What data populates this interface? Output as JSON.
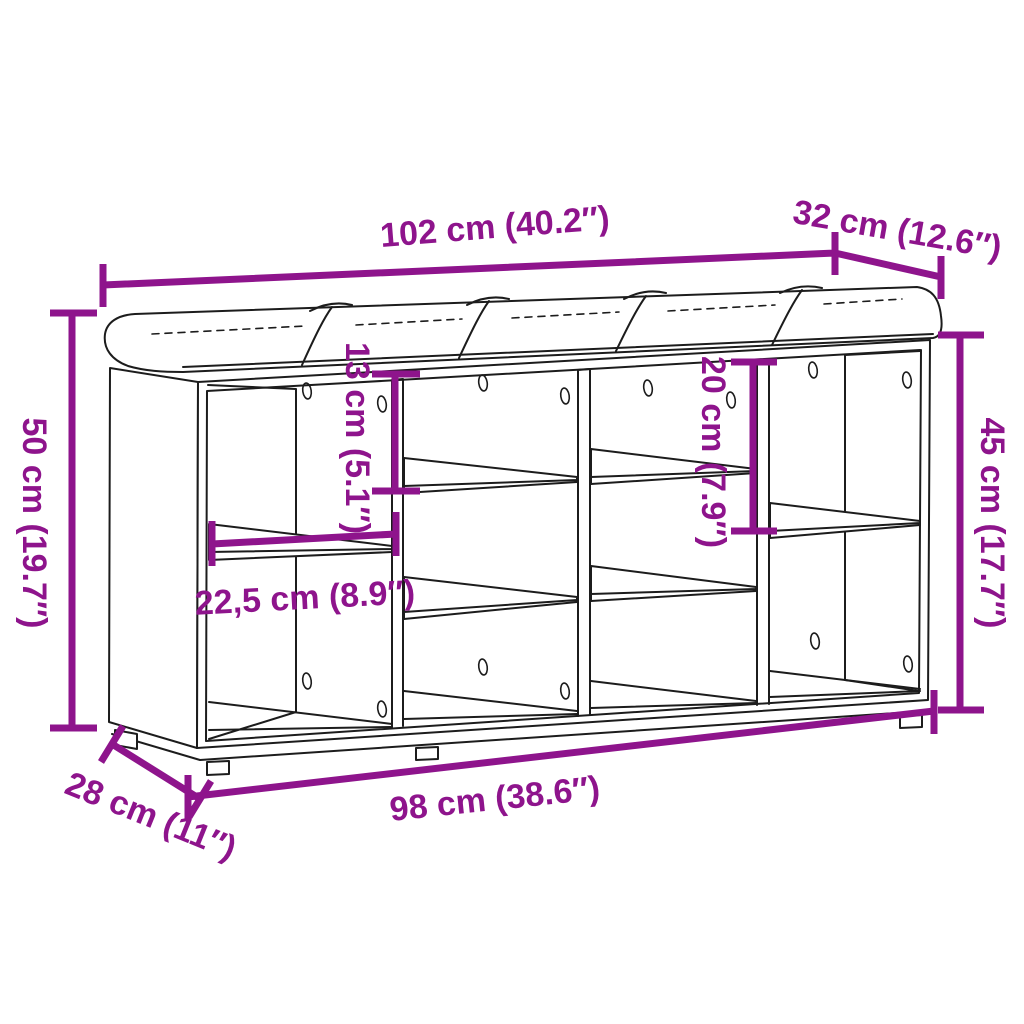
{
  "canvas": {
    "width": 1024,
    "height": 1024,
    "background": "#FFFFFF"
  },
  "colors": {
    "accent": "#8E148C",
    "outline": "#1C1C1C"
  },
  "diagram": {
    "dimensions": {
      "top_width": "102 cm (40.2″)",
      "top_depth": "32 cm (12.6″)",
      "left_height": "50 cm (19.7″)",
      "right_height": "45 cm (17.7″)",
      "inner_upper_height": "13 cm (5.1″)",
      "inner_right_height": "20 cm (7.9″)",
      "shelf_depth": "22,5 cm (8.9″)",
      "bottom_width": "98 cm (38.6″)",
      "bottom_depth": "28 cm (11″)"
    }
  }
}
